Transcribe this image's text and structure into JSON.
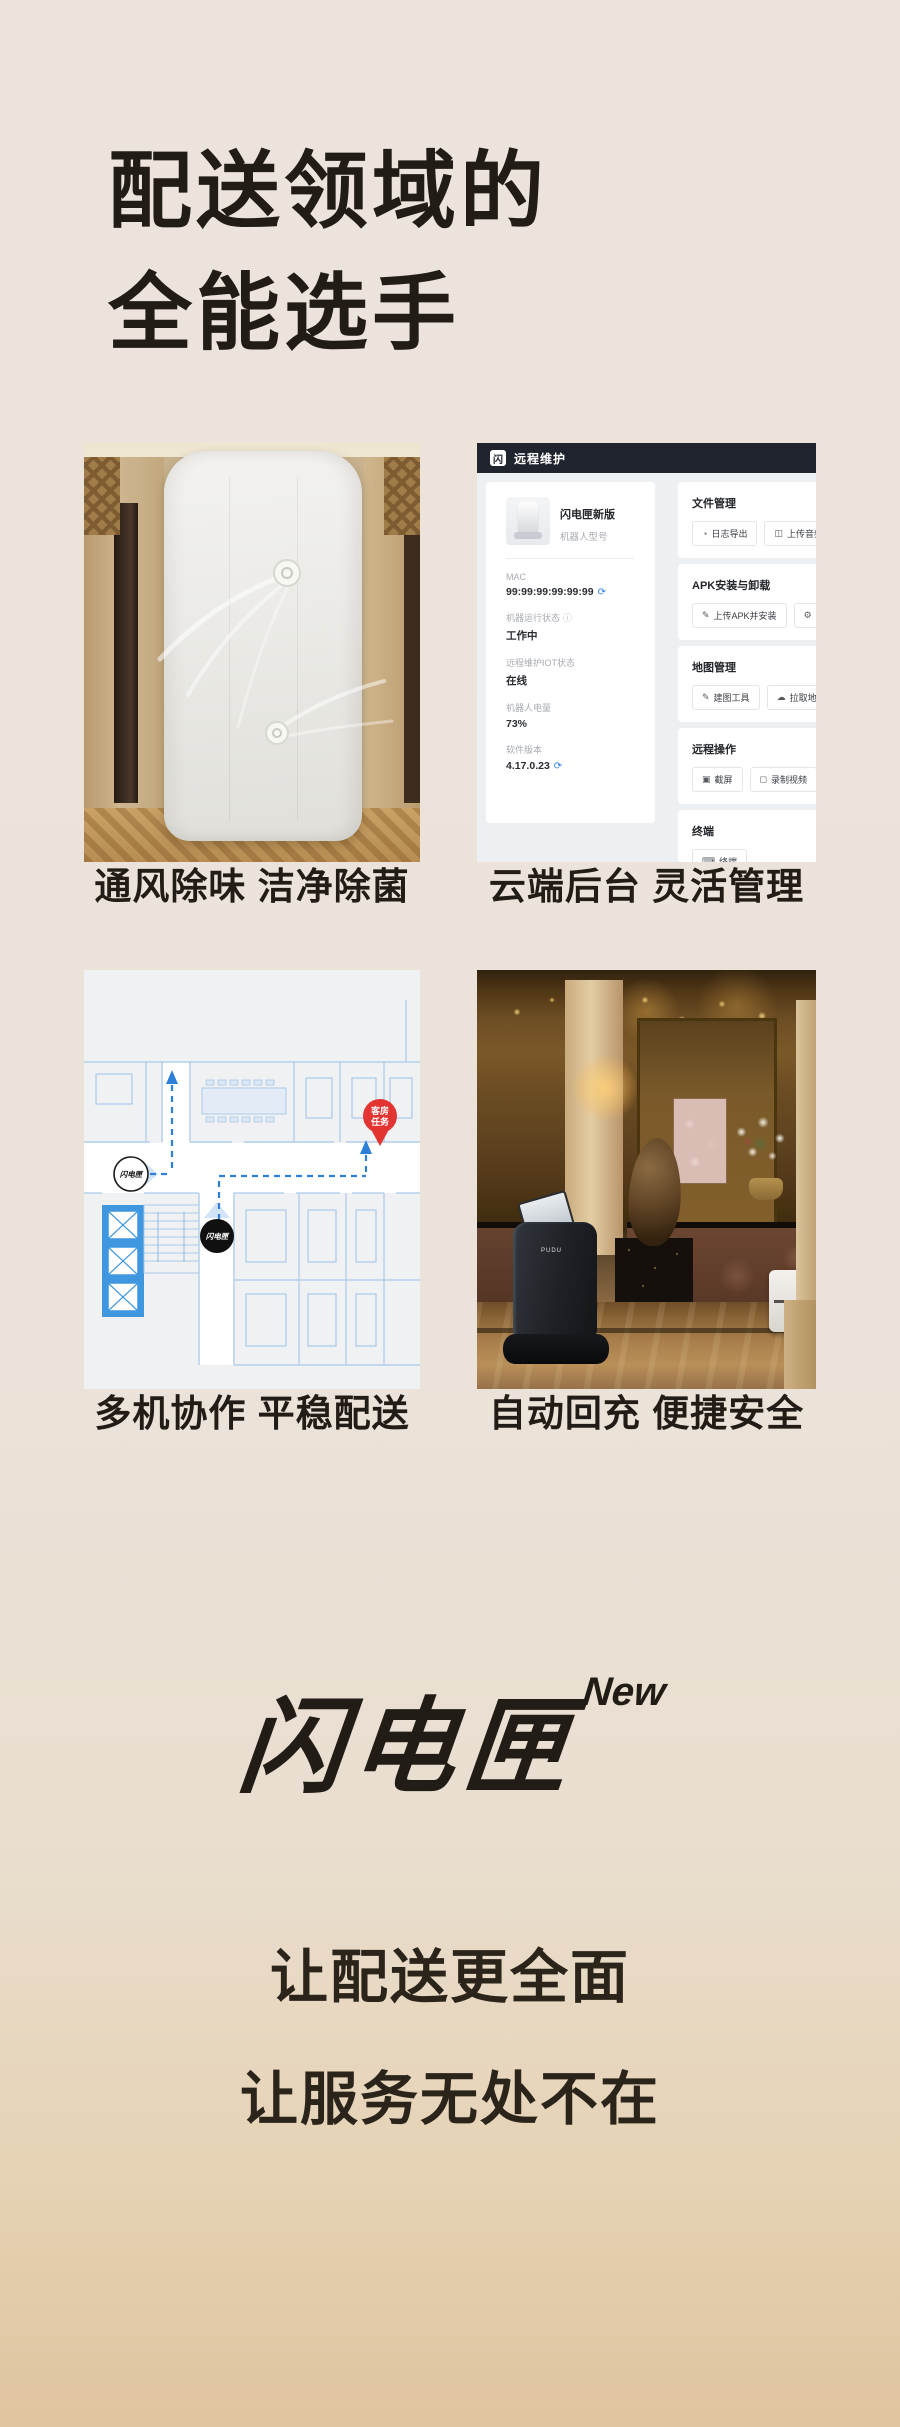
{
  "hero": {
    "title_line1": "配送领域的",
    "title_line2": "全能选手"
  },
  "features": [
    {
      "caption": "通风除味 洁净除菌",
      "media": "robot-rear-photo"
    },
    {
      "caption": "云端后台 灵活管理",
      "media": "remote-dashboard-screenshot"
    },
    {
      "caption": "多机协作 平稳配送",
      "media": "multi-robot-floorplan-map"
    },
    {
      "caption": "自动回充 便捷安全",
      "media": "lobby-charging-photo"
    }
  ],
  "dashboard": {
    "header": {
      "title": "远程维护",
      "logo_icon": "flash-logo-icon"
    },
    "device": {
      "name": "闪电匣新版",
      "model_label": "机器人型号",
      "fields": [
        {
          "label": "MAC",
          "value": "99:99:99:99:99:99",
          "icon": "refresh-icon"
        },
        {
          "label": "机器运行状态",
          "value": "工作中",
          "icon": "info-icon"
        },
        {
          "label": "远程维护IOT状态",
          "value": "在线"
        },
        {
          "label": "机器人电量",
          "value": "73%"
        },
        {
          "label": "软件版本",
          "value": "4.17.0.23",
          "icon": "refresh-icon"
        }
      ]
    },
    "sections": [
      {
        "title": "文件管理",
        "buttons": [
          {
            "label": "日志导出",
            "icon": "log-export-icon"
          },
          {
            "label": "上传音频",
            "icon": "upload-file-icon"
          },
          {
            "label": "",
            "icon": "file-icon",
            "truncated": true
          }
        ]
      },
      {
        "title": "APK安装与卸载",
        "buttons": [
          {
            "label": "上传APK并安装",
            "icon": "edit-icon"
          },
          {
            "label": "机器人软件",
            "icon": "gear-icon",
            "truncated": true
          }
        ]
      },
      {
        "title": "地图管理",
        "buttons": [
          {
            "label": "建图工具",
            "icon": "map-tool-icon"
          },
          {
            "label": "拉取地图",
            "icon": "cloud-download-icon"
          },
          {
            "label": "",
            "icon": "cloud-upload-icon",
            "truncated": true
          }
        ]
      },
      {
        "title": "远程操作",
        "buttons": [
          {
            "label": "截屏",
            "icon": "screenshot-icon"
          },
          {
            "label": "录制视频",
            "icon": "record-video-icon"
          },
          {
            "label": "远程",
            "icon": "remote-desktop-icon",
            "truncated": true
          }
        ]
      },
      {
        "title": "终端",
        "buttons": [
          {
            "label": "终端",
            "icon": "terminal-icon"
          }
        ]
      }
    ]
  },
  "map": {
    "pin_line1": "客房",
    "pin_line2": "任务",
    "robot_label": "闪电匣"
  },
  "lobby": {
    "robot_brand": "PUDU"
  },
  "brand": {
    "logo_text": "闪电匣",
    "badge": "New"
  },
  "slogan": {
    "line1": "让配送更全面",
    "line2": "让服务无处不在"
  },
  "colors": {
    "accent_blue": "#2f80ed",
    "pin_red": "#e23430",
    "header_dark": "#20242f",
    "page_bg_top": "#ece4dc",
    "page_bg_bottom": "#dfc49f"
  }
}
